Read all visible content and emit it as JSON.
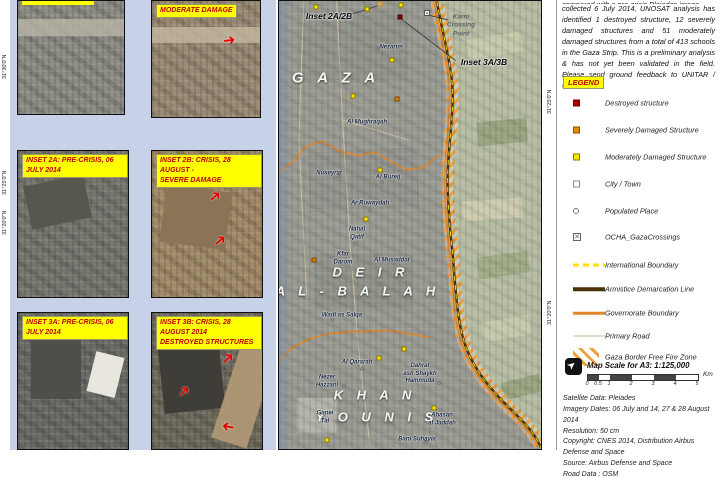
{
  "intro": {
    "clipped_line": "compared with a pre-crisis Pleiades image",
    "text": "collected 6 July 2014, UNOSAT analysis has identified 1 destroyed structure, 12 severely damaged structures and 51 moderately damaged structures from a total of 413 schools in the Gaza Strip. This is a preliminary analysis & has not yet been validated in the field. Please send ground feedback to UNITAR / UNOSAT."
  },
  "legend": {
    "title": "LEGEND",
    "items": [
      {
        "sym": "sq-red",
        "label": "Destroyed structure",
        "y": 96
      },
      {
        "sym": "sq-orange",
        "label": "Severely Damaged Structure",
        "y": 123
      },
      {
        "sym": "sq-yellow",
        "label": "Moderately Damaged Structure",
        "y": 150
      },
      {
        "sym": "sq-white",
        "label": "City / Town",
        "y": 177
      },
      {
        "sym": "circle",
        "label": "Populated Place",
        "y": 204
      },
      {
        "sym": "crossing",
        "label": "OCHA_GazaCrossings",
        "y": 230
      },
      {
        "sym": "line-intl",
        "label": "International Boundary",
        "y": 258
      },
      {
        "sym": "line-armistice",
        "label": "Armistice Demarcation Line",
        "y": 282
      },
      {
        "sym": "line-gov",
        "label": "Governorate Boundary",
        "y": 306
      },
      {
        "sym": "line-road",
        "label": "Primary Road",
        "y": 329
      },
      {
        "sym": "hatch",
        "label": "Gaza Border Free Fire Zone",
        "y": 350
      }
    ],
    "crossing_glyph": "✕"
  },
  "scale": {
    "title": "Map Scale for A3: 1:125,000",
    "north_glyph": "➤",
    "ticks": [
      {
        "t": "0",
        "px": 0
      },
      {
        "t": "0.5",
        "px": 11
      },
      {
        "t": "1",
        "px": 22
      },
      {
        "t": "2",
        "px": 44
      },
      {
        "t": "3",
        "px": 66
      },
      {
        "t": "4",
        "px": 88
      },
      {
        "t": "5",
        "px": 110
      }
    ],
    "segments": [
      "b",
      "w",
      "b",
      "w",
      "b",
      "w"
    ],
    "unit": "Km"
  },
  "credits": {
    "lines": [
      "Satellite Data: Pleiades",
      "Imagery Dates: 06 July and 14, 27 & 28 August 2014",
      "Resolution: 50 cm",
      "Copyright: CNES 2014, Distribution Airbus Defense and Space",
      "Source: Airbus Defense and Space",
      "Road Data : OSM"
    ]
  },
  "insets": [
    {
      "id": "1a",
      "label_lines": [],
      "clipped": true,
      "tex": "sat1a",
      "arrows": []
    },
    {
      "id": "1b",
      "label_lines": [
        "MODERATE DAMAGE"
      ],
      "clipped": false,
      "tex": "sat1b",
      "arrows": [
        {
          "x": 66,
          "y": 28,
          "rot": -8
        }
      ]
    },
    {
      "id": "2a",
      "label_lines": [
        "INSET 2A: PRE-CRISIS, 06 JULY 2014"
      ],
      "clipped": false,
      "tex": "sat2a",
      "arrows": []
    },
    {
      "id": "2b",
      "label_lines": [
        "INSET 2B: CRISIS, 28 AUGUST -",
        "SEVERE DAMAGE"
      ],
      "clipped": false,
      "tex": "sat2b",
      "arrows": [
        {
          "x": 52,
          "y": 26,
          "rot": -40
        },
        {
          "x": 56,
          "y": 56,
          "rot": -40
        }
      ]
    },
    {
      "id": "3a",
      "label_lines": [
        "INSET 3A: PRE-CRISIS, 06 JULY 2014"
      ],
      "clipped": false,
      "tex": "sat3a",
      "arrows": []
    },
    {
      "id": "3b",
      "label_lines": [
        "INSET 3B: CRISIS, 28 AUGUST 2014",
        "DESTROYED STRUCTURES"
      ],
      "clipped": false,
      "tex": "sat3b",
      "arrows": [
        {
          "x": 64,
          "y": 28,
          "rot": -45
        },
        {
          "x": 24,
          "y": 52,
          "rot": -45
        },
        {
          "x": 64,
          "y": 78,
          "rot": 190
        }
      ]
    }
  ],
  "arrow_glyph": "➜",
  "margins": {
    "left_labels": [
      {
        "text": "31°30'0\"N",
        "y": 62
      },
      {
        "text": "31°25'0\"N",
        "y": 178
      },
      {
        "text": "31°20'0\"N",
        "y": 218
      }
    ],
    "right_labels": [
      {
        "text": "31°25'0\"N",
        "y": 97
      },
      {
        "text": "31°20'0\"N",
        "y": 308
      }
    ]
  },
  "map": {
    "region_labels": [
      {
        "text": "G A Z A",
        "x": 57,
        "y": 77,
        "size": 15
      },
      {
        "text": "D E I R",
        "x": 92,
        "y": 271,
        "size": 13
      },
      {
        "text": "A L - B A L A H",
        "x": 79,
        "y": 290,
        "size": 13
      },
      {
        "text": "K H A N",
        "x": 96,
        "y": 394,
        "size": 13
      },
      {
        "text": "Y O U N I S",
        "x": 98,
        "y": 416,
        "size": 13
      }
    ],
    "places": [
      {
        "text": "Nezarim",
        "x": 112,
        "y": 47
      },
      {
        "text": "Al Mughraqah",
        "x": 88,
        "y": 122
      },
      {
        "text": "Nuseyrat",
        "x": 50,
        "y": 173
      },
      {
        "text": "Al Bureij",
        "x": 109,
        "y": 177
      },
      {
        "text": "Ar Ruwaydah",
        "x": 91,
        "y": 203
      },
      {
        "text": "Nahal\nQatif",
        "x": 78,
        "y": 233
      },
      {
        "text": "Kfar\nDarom",
        "x": 64,
        "y": 258
      },
      {
        "text": "Al Musaddar",
        "x": 113,
        "y": 260
      },
      {
        "text": "Wadi as Salqa",
        "x": 63,
        "y": 315
      },
      {
        "text": "Al Qararah",
        "x": 78,
        "y": 362
      },
      {
        "text": "Dahrat\nash Shaykh\nHammuda",
        "x": 141,
        "y": 373
      },
      {
        "text": "Nezer\nHazzani",
        "x": 48,
        "y": 381
      },
      {
        "text": "Ganei\nTal",
        "x": 46,
        "y": 417
      },
      {
        "text": "Abasan\nal Jaddah",
        "x": 163,
        "y": 419
      },
      {
        "text": "Bani Suhayla",
        "x": 138,
        "y": 439
      }
    ],
    "callouts": [
      {
        "text": "Inset 2A/2B",
        "x": 50,
        "y": 15
      },
      {
        "text": "Inset 3A/3B",
        "x": 205,
        "y": 61
      }
    ],
    "crossing_label": {
      "text": "Karni\nCrossing\nPoint",
      "x": 182,
      "y": 25
    },
    "markers": [
      {
        "t": "moderate",
        "x": 37,
        "y": 6
      },
      {
        "t": "moderate",
        "x": 88,
        "y": 8
      },
      {
        "t": "moderate",
        "x": 122,
        "y": 4
      },
      {
        "t": "moderate",
        "x": 74,
        "y": 95
      },
      {
        "t": "moderate",
        "x": 113,
        "y": 59
      },
      {
        "t": "moderate",
        "x": 101,
        "y": 169
      },
      {
        "t": "moderate",
        "x": 87,
        "y": 218
      },
      {
        "t": "moderate",
        "x": 125,
        "y": 348
      },
      {
        "t": "moderate",
        "x": 100,
        "y": 357
      },
      {
        "t": "moderate",
        "x": 155,
        "y": 407
      },
      {
        "t": "moderate",
        "x": 48,
        "y": 439
      },
      {
        "t": "severe",
        "x": 35,
        "y": 259
      },
      {
        "t": "severe",
        "x": 118,
        "y": 98
      },
      {
        "t": "destroyed",
        "x": 121,
        "y": 16
      },
      {
        "t": "city",
        "x": 101,
        "y": 3
      },
      {
        "t": "crossing",
        "x": 148,
        "y": 12
      },
      {
        "t": "populated",
        "x": 99,
        "y": 47
      },
      {
        "t": "populated",
        "x": 60,
        "y": 175
      },
      {
        "t": "populated",
        "x": 103,
        "y": 181
      },
      {
        "t": "populated",
        "x": 91,
        "y": 210
      },
      {
        "t": "populated",
        "x": 76,
        "y": 243
      },
      {
        "t": "populated",
        "x": 97,
        "y": 255
      },
      {
        "t": "populated",
        "x": 100,
        "y": 284
      },
      {
        "t": "populated",
        "x": 53,
        "y": 319
      },
      {
        "t": "populated",
        "x": 83,
        "y": 368
      },
      {
        "t": "populated",
        "x": 160,
        "y": 382
      },
      {
        "t": "populated",
        "x": 65,
        "y": 385
      },
      {
        "t": "populated",
        "x": 58,
        "y": 420
      },
      {
        "t": "populated",
        "x": 147,
        "y": 441
      }
    ]
  },
  "colors": {
    "accent_yellow": "#ffff00",
    "label_red": "#c00000",
    "governorate_orange": "#e0862c",
    "armistice_brown": "#4a3208",
    "intl_yellow": "#ffe000",
    "hatch_orange": "#ef9f3f",
    "inset_panel_blue": "#c7d1e8"
  }
}
